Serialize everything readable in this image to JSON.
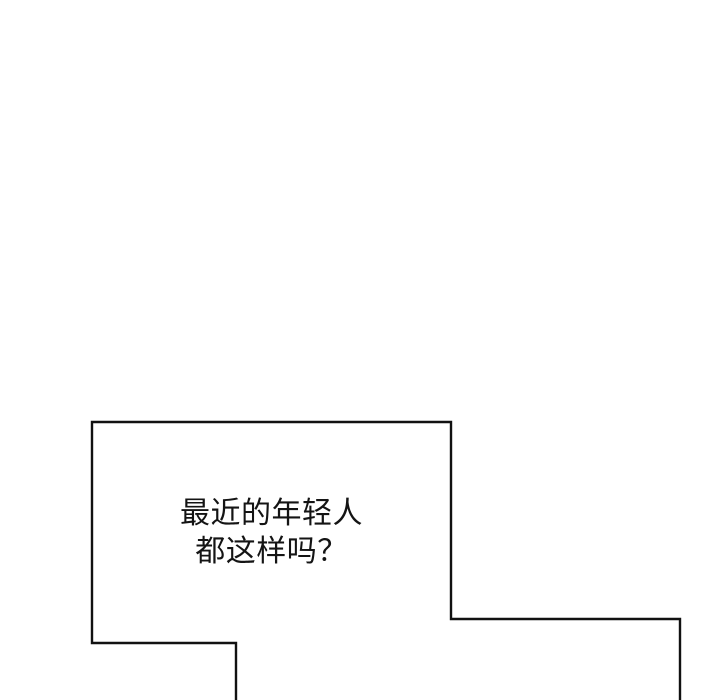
{
  "colors": {
    "background": "#ffffff",
    "line": "#111111",
    "text": "#141414"
  },
  "speech_bubble": {
    "lines": [
      "最近的年轻人",
      "都这样吗？"
    ]
  }
}
